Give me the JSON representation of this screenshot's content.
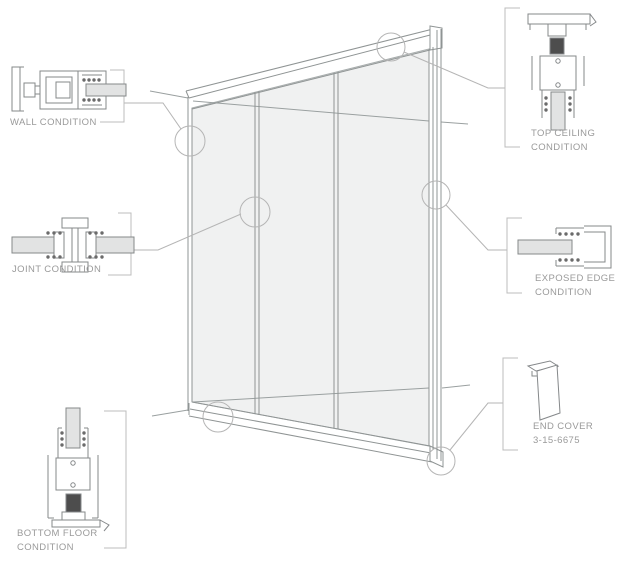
{
  "diagram": {
    "type": "glass-partition-wall-system-detail-diagram",
    "panel_count": 3,
    "callouts": {
      "wall": {
        "line1": "WALL CONDITION"
      },
      "joint": {
        "line1": "JOINT CONDITION"
      },
      "bottom_floor": {
        "line1": "BOTTOM FLOOR",
        "line2": "CONDITION"
      },
      "top_ceiling": {
        "line1": "TOP CEILING",
        "line2": "CONDITION"
      },
      "exposed_edge": {
        "line1": "EXPOSED EDGE",
        "line2": "CONDITION"
      },
      "end_cover": {
        "line1": "END COVER",
        "line2": "3-15-6675"
      }
    }
  },
  "colors": {
    "background": "#ffffff",
    "main_line": "#8f9494",
    "detail_line": "#85888a",
    "light_line": "#b5b5b5",
    "glass_fill": "#f0f1f1",
    "detail_glass_fill": "#e2e3e3",
    "shim_fill": "#4d4d4d",
    "gasket_dot": "#6b6b6b",
    "label_text": "#9a9a9a"
  }
}
